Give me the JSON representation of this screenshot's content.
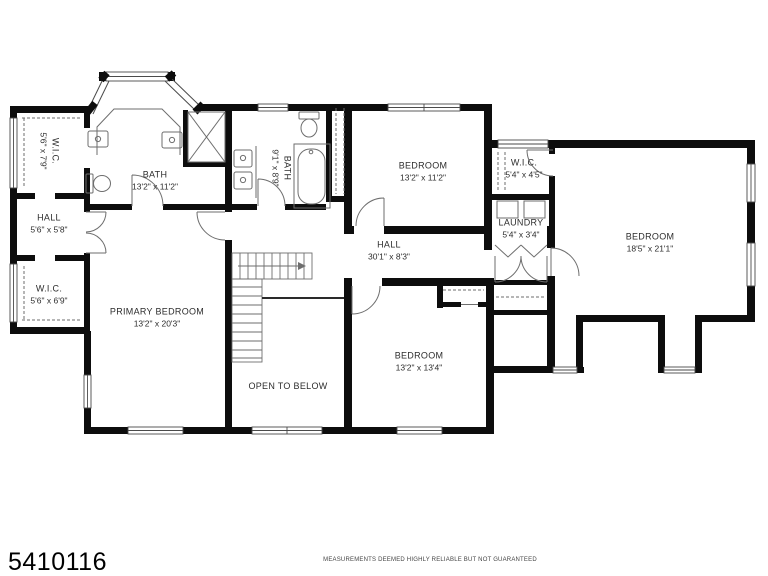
{
  "footer": {
    "mls_number": "5410116",
    "disclaimer": "MEASUREMENTS DEEMED HIGHLY RELIABLE BUT NOT GUARANTEED"
  },
  "rooms": [
    {
      "name": "W.I.C.",
      "dims": "5'6\" x 7'9\""
    },
    {
      "name": "HALL",
      "dims": "5'6\" x 5'8\""
    },
    {
      "name": "W.I.C.",
      "dims": "5'6\" x 6'9\""
    },
    {
      "name": "BATH",
      "dims": "13'2\" x 11'2\""
    },
    {
      "name": "BATH",
      "dims": "9'1\" x 8'9\""
    },
    {
      "name": "BEDROOM",
      "dims": "13'2\" x 11'2\""
    },
    {
      "name": "W.I.C.",
      "dims": "5'4\" x 4'5\""
    },
    {
      "name": "LAUNDRY",
      "dims": "5'4\" x 3'4\""
    },
    {
      "name": "HALL",
      "dims": "30'1\" x 8'3\""
    },
    {
      "name": "BEDROOM",
      "dims": "18'5\" x 21'1\""
    },
    {
      "name": "PRIMARY BEDROOM",
      "dims": "13'2\" x 20'3\""
    },
    {
      "name": "BEDROOM",
      "dims": "13'2\" x 13'4\""
    },
    {
      "name": "OPEN TO BELOW",
      "dims": ""
    }
  ],
  "colors": {
    "wall": "#0d0d0d",
    "fixture": "#6e6e6e",
    "window_stroke": "#4a4a4a",
    "label": "#2d2d2d",
    "background": "#ffffff"
  }
}
